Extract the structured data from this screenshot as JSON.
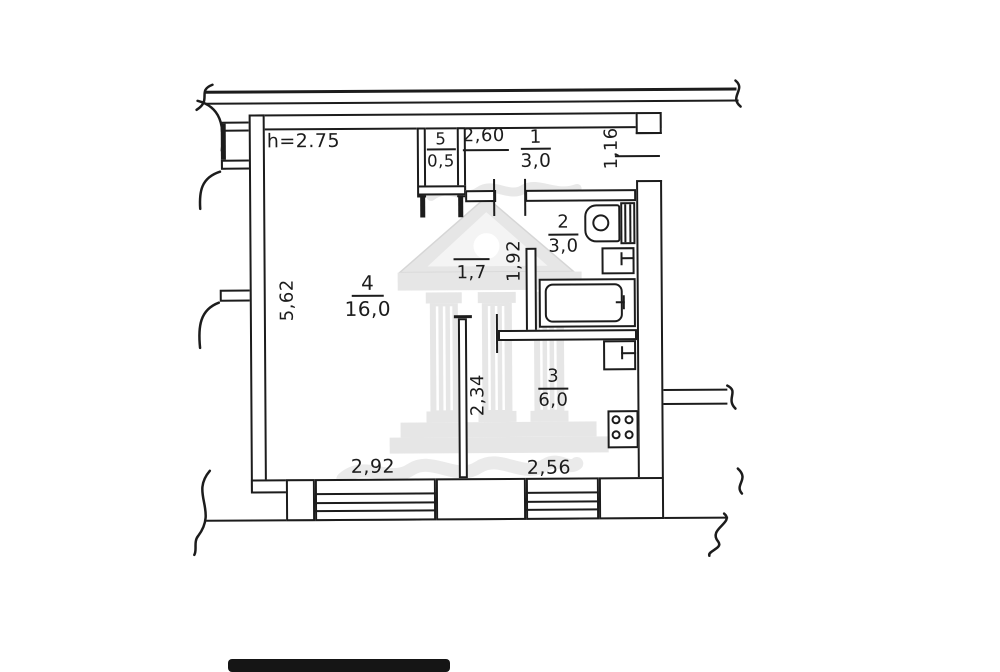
{
  "plan": {
    "ceiling_height": "h=2.75",
    "rooms": {
      "hallway": {
        "number": "1",
        "area": "3,0"
      },
      "bathroom": {
        "number": "2",
        "area": "3,0"
      },
      "kitchen": {
        "number": "3",
        "area": "6,0"
      },
      "living": {
        "number": "4",
        "area": "16,0"
      },
      "closet": {
        "number": "5",
        "area": "0,5"
      },
      "corridor": {
        "area": "1,7"
      }
    },
    "dimensions": {
      "hallway_width": "2,60",
      "entry_wall": "1,16",
      "corridor_depth": "1,92",
      "living_height": "5,62",
      "kitchen_depth": "2,34",
      "living_width": "2,92",
      "kitchen_width": "2,56"
    },
    "colors": {
      "line": "#1c1c1c",
      "watermark": "#e1e1e1",
      "background": "#ffffff"
    }
  }
}
